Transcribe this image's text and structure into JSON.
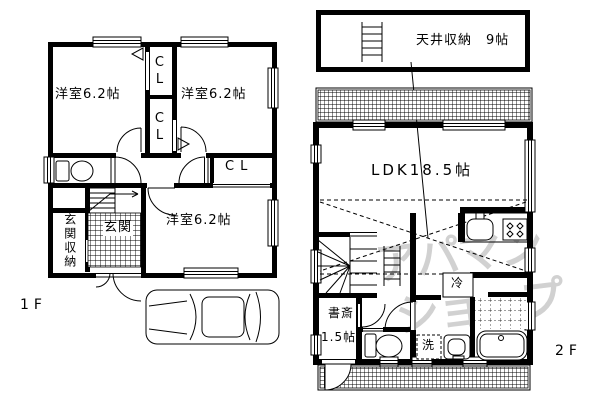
{
  "floor1": {
    "label": "1F",
    "bedroom_nw": "洋室6.2帖",
    "bedroom_ne": "洋室6.2帖",
    "bedroom_s": "洋室6.2帖",
    "closet_top": "CL",
    "closet_mid": "CL",
    "closet_hall": "CL",
    "entrance": "玄関",
    "entrance_storage": "玄関収納"
  },
  "floor2": {
    "label": "2F",
    "attic": "天井収納　9帖",
    "ldk": "LDK18.5帖",
    "study_name": "書斎",
    "study_size": "1.5帖",
    "fridge": "冷",
    "washer": "洗"
  },
  "watermark": {
    "line1": "アパマン",
    "line2": "ショップ"
  },
  "colors": {
    "wall": "#000000",
    "background": "#ffffff",
    "watermark": "#c9c9c9"
  }
}
